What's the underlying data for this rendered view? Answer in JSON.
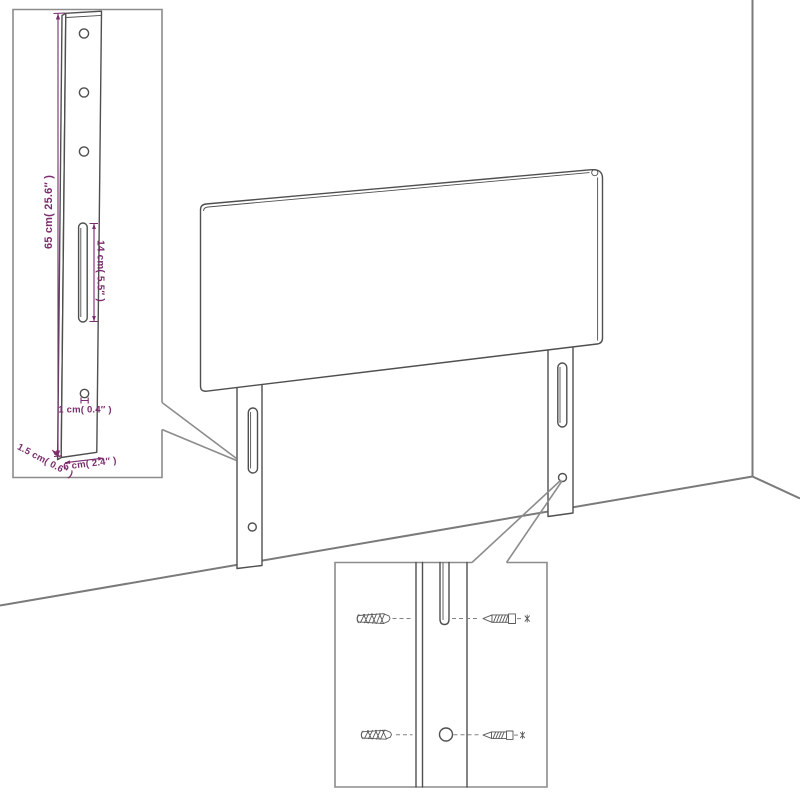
{
  "colors": {
    "background": "#ffffff",
    "line": "#4f4f4f",
    "wall": "#7a7a7a",
    "box": "#8c8c8c",
    "dimension": "#7b2c6d"
  },
  "insets": {
    "leg_detail": {
      "labels": {
        "length": "65 cm( 25.6″ )",
        "slot": "14 cm( 5.5″ )",
        "hole": "1 cm( 0.4″ )",
        "depth": "1.5 cm( 0.6″ )",
        "width": "6 cm( 2.4″ )"
      }
    },
    "mounting_detail": {
      "icons": {
        "left": "wall-plug-icon",
        "right": "screw-icon"
      }
    }
  }
}
